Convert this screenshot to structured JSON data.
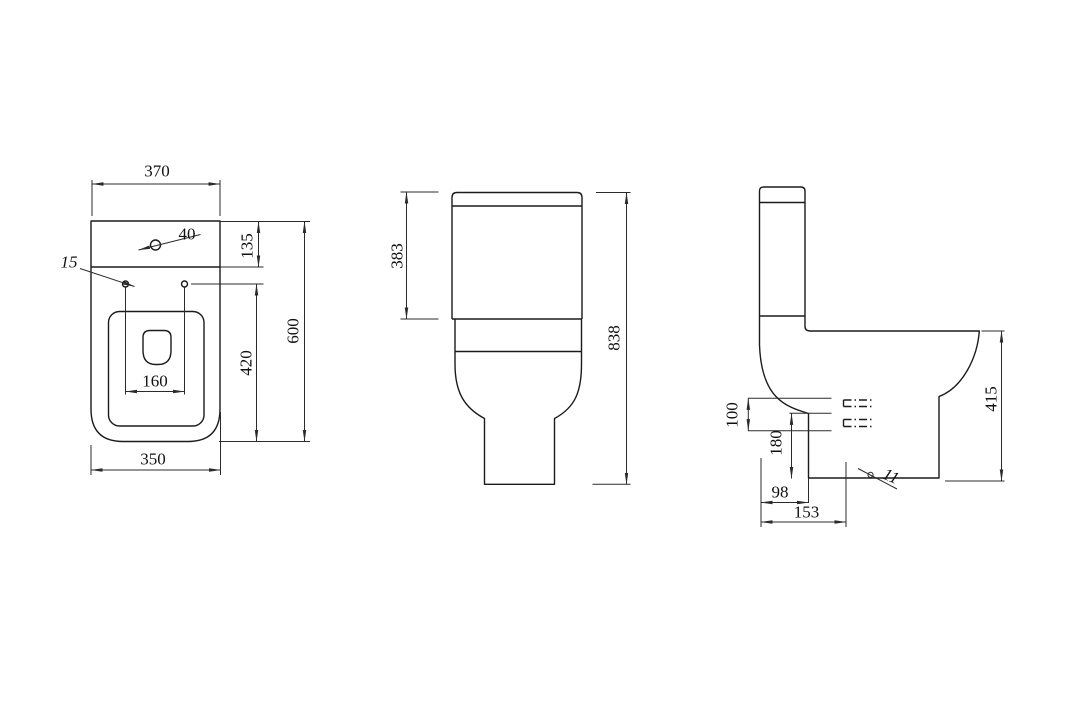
{
  "description": "Three-view dimensioned technical drawing of a close-coupled toilet (top view, front view, side view)",
  "views": {
    "top_view": {
      "dimensions": [
        "370",
        "40",
        "15",
        "135",
        "160",
        "420",
        "600",
        "350"
      ]
    },
    "front_view": {
      "dimensions": [
        "383",
        "838"
      ]
    },
    "side_view": {
      "dimensions": [
        "100",
        "180",
        "98",
        "153",
        "11",
        "415"
      ]
    }
  },
  "labels": {
    "d370": "370",
    "d40": "40",
    "d15": "15",
    "d135": "135",
    "d600": "600",
    "d420": "420",
    "d160": "160",
    "d350": "350",
    "d383": "383",
    "d838": "838",
    "d100": "100",
    "d180": "180",
    "d98": "98",
    "d153": "153",
    "d11": "11",
    "d415": "415"
  }
}
